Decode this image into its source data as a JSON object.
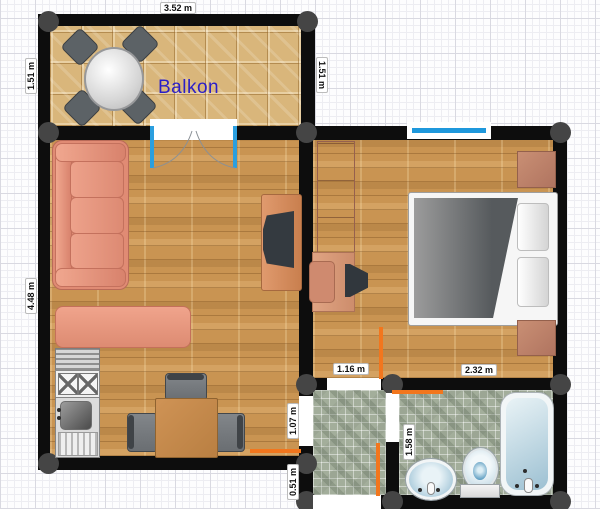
{
  "rooms": {
    "balcony_label": "Balkon"
  },
  "dimensions": {
    "balcony_width": "3.52 m",
    "balcony_depth_left": "1.51 m",
    "balcony_depth_right": "1.51 m",
    "living_room_depth": "4.48 m",
    "bedroom_door_width": "1.16 m",
    "bed_zone_width": "2.32 m",
    "living_door_height": "1.07 m",
    "entry_width": "0.51 m",
    "bathroom_depth": "1.58 m"
  },
  "colors": {
    "wall": "#0d0d0d",
    "corner_post": "#454545",
    "open_door_marker": "#f2761d",
    "window_glass": "#1e98dc",
    "door_frame": "#2b9fdf",
    "balcony_text": "#2a1ec8",
    "upholstery": "#e08b74",
    "wood_floor": "#c99452",
    "balcony_tile": "#d9b67b",
    "bath_tile": "#a3ae9b"
  }
}
